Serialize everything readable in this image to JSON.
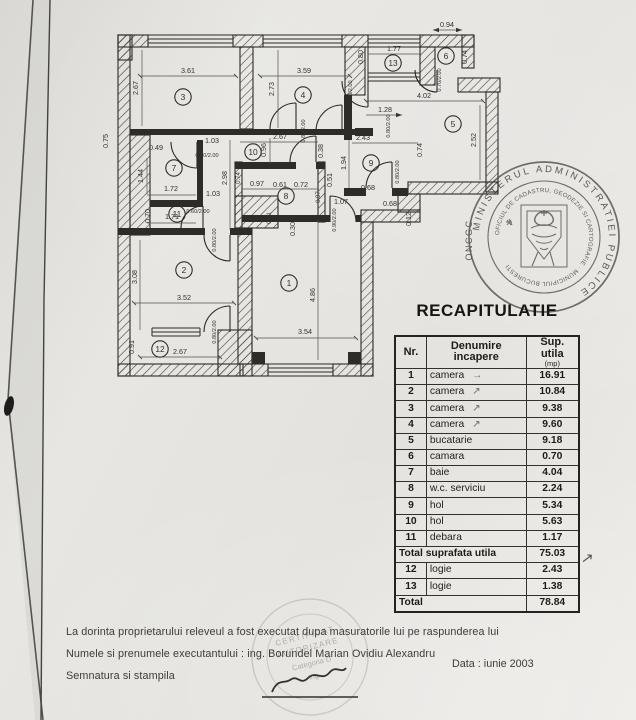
{
  "colors": {
    "paper": "#e7e5e1",
    "plan_ink": "#2e2c29",
    "table_ink": "#1d1c1a",
    "stamp_ink": "#4c4a47"
  },
  "plan": {
    "room_labels": [
      {
        "n": "3",
        "x": 183,
        "y": 97
      },
      {
        "n": "4",
        "x": 303,
        "y": 95
      },
      {
        "n": "13",
        "x": 393,
        "y": 63
      },
      {
        "n": "6",
        "x": 446,
        "y": 56
      },
      {
        "n": "5",
        "x": 453,
        "y": 124
      },
      {
        "n": "10",
        "x": 253,
        "y": 152
      },
      {
        "n": "7",
        "x": 174,
        "y": 168
      },
      {
        "n": "11",
        "x": 177,
        "y": 214
      },
      {
        "n": "9",
        "x": 371,
        "y": 163
      },
      {
        "n": "8",
        "x": 286,
        "y": 196
      },
      {
        "n": "2",
        "x": 184,
        "y": 270
      },
      {
        "n": "1",
        "x": 289,
        "y": 283
      },
      {
        "n": "12",
        "x": 160,
        "y": 349
      }
    ],
    "dim_labels": [
      {
        "t": "0.94",
        "x": 447,
        "y": 27
      },
      {
        "t": "3.61",
        "x": 188,
        "y": 73
      },
      {
        "t": "2.67",
        "x": 138,
        "y": 88,
        "r": 1
      },
      {
        "t": "3.59",
        "x": 304,
        "y": 73
      },
      {
        "t": "2.73",
        "x": 274,
        "y": 89,
        "r": 1
      },
      {
        "t": "1.77",
        "x": 394,
        "y": 51
      },
      {
        "t": "0.80",
        "x": 363,
        "y": 57,
        "r": 1
      },
      {
        "t": "0.80/2.00",
        "x": 352,
        "y": 92,
        "r": 1,
        "fs": 5.6
      },
      {
        "t": "0.74",
        "x": 467,
        "y": 57,
        "r": 1
      },
      {
        "t": "0.70/2.00",
        "x": 441,
        "y": 80,
        "r": 1,
        "fs": 5.6
      },
      {
        "t": "4.02",
        "x": 424,
        "y": 98
      },
      {
        "t": "1.28",
        "x": 385,
        "y": 112
      },
      {
        "t": "2.52",
        "x": 476,
        "y": 140,
        "r": 1
      },
      {
        "t": "0.74",
        "x": 422,
        "y": 150,
        "r": 1
      },
      {
        "t": "0.80/2.00",
        "x": 399,
        "y": 172,
        "r": 1,
        "fs": 5.6
      },
      {
        "t": "2.67",
        "x": 280,
        "y": 139
      },
      {
        "t": "0.96",
        "x": 266,
        "y": 150,
        "r": 1
      },
      {
        "t": "0.38",
        "x": 323,
        "y": 151,
        "r": 1
      },
      {
        "t": "1.03",
        "x": 212,
        "y": 143
      },
      {
        "t": "0.80/2.00",
        "x": 305,
        "y": 131,
        "r": 1,
        "fs": 5.6
      },
      {
        "t": "0.80/2.00",
        "x": 390,
        "y": 126,
        "r": 1,
        "fs": 5.6
      },
      {
        "t": "0.75",
        "x": 108,
        "y": 141,
        "r": 1
      },
      {
        "t": "0.49",
        "x": 156,
        "y": 150
      },
      {
        "t": "1.44",
        "x": 143,
        "y": 176,
        "r": 1
      },
      {
        "t": "1.72",
        "x": 171,
        "y": 191
      },
      {
        "t": "0.60/2.00",
        "x": 207,
        "y": 157,
        "fs": 5.6
      },
      {
        "t": "2.98",
        "x": 227,
        "y": 178,
        "r": 1
      },
      {
        "t": "1.03",
        "x": 213,
        "y": 196
      },
      {
        "t": "0.70",
        "x": 150,
        "y": 216,
        "r": 1
      },
      {
        "t": "1.71",
        "x": 172,
        "y": 219
      },
      {
        "t": "0.60/2.00",
        "x": 198,
        "y": 213,
        "fs": 5.6
      },
      {
        "t": "0.97",
        "x": 257,
        "y": 186
      },
      {
        "t": "0.61",
        "x": 280,
        "y": 187
      },
      {
        "t": "0.72",
        "x": 301,
        "y": 187
      },
      {
        "t": "0.74",
        "x": 240,
        "y": 178,
        "r": 1,
        "fs": 6
      },
      {
        "t": "0.97",
        "x": 320,
        "y": 197,
        "r": 1,
        "fs": 6
      },
      {
        "t": "0.31",
        "x": 271,
        "y": 218,
        "r": 1,
        "fs": 6
      },
      {
        "t": "0.30",
        "x": 295,
        "y": 229,
        "r": 1
      },
      {
        "t": "2.43",
        "x": 363,
        "y": 140
      },
      {
        "t": "1.94",
        "x": 346,
        "y": 163,
        "r": 1
      },
      {
        "t": "0.51",
        "x": 332,
        "y": 180,
        "r": 1
      },
      {
        "t": "0.68",
        "x": 368,
        "y": 190
      },
      {
        "t": "1.07",
        "x": 341,
        "y": 204
      },
      {
        "t": "0.68",
        "x": 390,
        "y": 206
      },
      {
        "t": "0.12",
        "x": 411,
        "y": 219,
        "r": 1
      },
      {
        "t": "0.90/2.00",
        "x": 336,
        "y": 220,
        "r": 1,
        "fs": 5.6
      },
      {
        "t": "3.08",
        "x": 137,
        "y": 277,
        "r": 1
      },
      {
        "t": "3.52",
        "x": 184,
        "y": 300
      },
      {
        "t": "0.80/2.00",
        "x": 216,
        "y": 240,
        "r": 1,
        "fs": 5.6
      },
      {
        "t": "0.80/2.00",
        "x": 216,
        "y": 332,
        "r": 1,
        "fs": 5.6
      },
      {
        "t": "0.91",
        "x": 134,
        "y": 347,
        "r": 1
      },
      {
        "t": "2.67",
        "x": 180,
        "y": 354
      },
      {
        "t": "4.86",
        "x": 315,
        "y": 295,
        "r": 1
      },
      {
        "t": "3.54",
        "x": 305,
        "y": 334
      }
    ]
  },
  "table": {
    "title": "RECAPITULATIE",
    "col_nr": "Nr.",
    "col_name": "Denumire incapere",
    "col_sup": "Sup. utila",
    "col_sup_unit": "(mp)",
    "side_arrow": "↗",
    "rows": [
      {
        "nr": "1",
        "name": "camera",
        "value": "16.91",
        "mark": "→"
      },
      {
        "nr": "2",
        "name": "camera",
        "value": "10.84",
        "mark": "↗"
      },
      {
        "nr": "3",
        "name": "camera",
        "value": "9.38",
        "mark": "↗"
      },
      {
        "nr": "4",
        "name": "camera",
        "value": "9.60",
        "mark": "↗"
      },
      {
        "nr": "5",
        "name": "bucatarie",
        "value": "9.18"
      },
      {
        "nr": "6",
        "name": "camara",
        "value": "0.70"
      },
      {
        "nr": "7",
        "name": "baie",
        "value": "4.04"
      },
      {
        "nr": "8",
        "name": "w.c. serviciu",
        "value": "2.24"
      },
      {
        "nr": "9",
        "name": "hol",
        "value": "5.34"
      },
      {
        "nr": "10",
        "name": "hol",
        "value": "5.63"
      },
      {
        "nr": "11",
        "name": "debara",
        "value": "1.17"
      },
      {
        "span": "Total suprafata utila",
        "value": "75.03",
        "total": true
      },
      {
        "nr": "12",
        "name": "logie",
        "value": "2.43"
      },
      {
        "nr": "13",
        "name": "logie",
        "value": "1.38"
      },
      {
        "span": "Total",
        "value": "78.84",
        "total": true
      }
    ]
  },
  "stamp": {
    "ring_outer": "MINISTERUL  ADMINISTRATIEI  PUBLICE",
    "ring_side": "ONCGC",
    "ring_inner": "OFICIUL DE CADASTRU, GEODEZIE SI CARTOGRAFIE · MUNICIPIUL BUCURESTI"
  },
  "cert_stamp": {
    "lines": [
      "CERTIFICAT",
      "AUTORIZARE",
      "Categoria D",
      "ing."
    ]
  },
  "footer": {
    "line1": "La dorinta proprietarului releveul a fost executat dupa masuratorile lui pe raspunderea lui",
    "line2": "Numele si prenumele executantului :  ing. Borundel Marian Ovidiu Alexandru",
    "line3": "Semnatura si stampila",
    "date_label": "Data :  iunie 2003"
  }
}
